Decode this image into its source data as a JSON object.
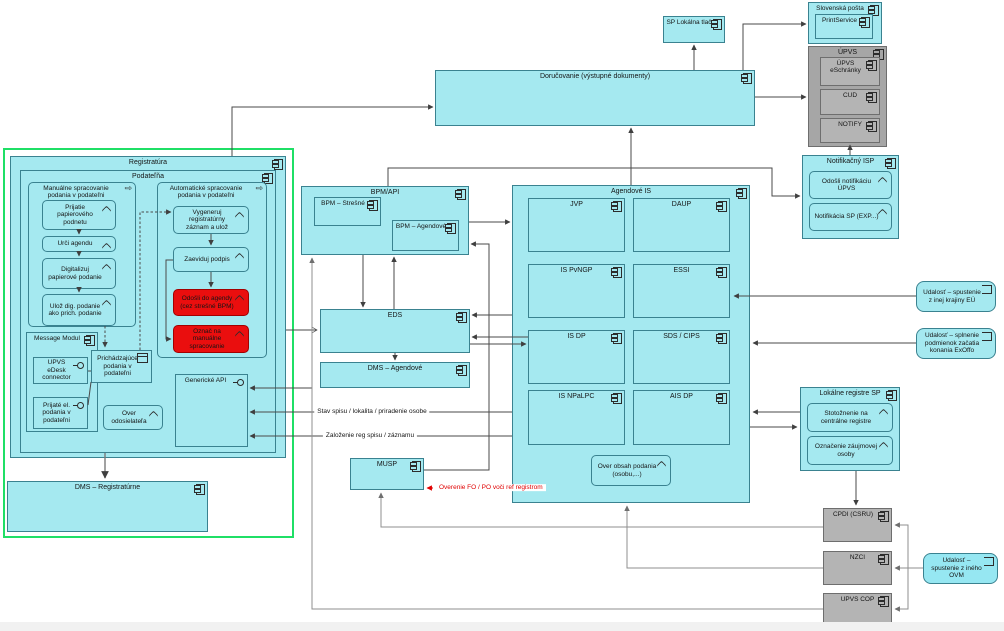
{
  "colors": {
    "node_fill": "#a5e9f0",
    "gray_fill": "#b4b4b4",
    "alert_fill": "#ea0e0e",
    "highlight_frame": "#1fdf66",
    "annotation_red": "#e00000"
  },
  "registratura": {
    "title": "Registratúra"
  },
  "podatelna": {
    "title": "Podateľňa"
  },
  "manualne": {
    "title": "Manuálne spracovanie podania v podateľni",
    "steps": [
      "Prijatie papierového podnetu",
      "Urči agendu",
      "Digitalizuj papierové podanie",
      "Ulož dig. podanie ako prich. podanie"
    ]
  },
  "automaticke": {
    "title": "Automatické spracovanie podania v podateľni",
    "steps": [
      "Vygeneruj registratúrny záznam a ulož",
      "Zaeviduj podpis"
    ],
    "alerts": [
      "Odošli do agendy (cez strešné BPM)",
      "Označ na manuálne spracovanie"
    ]
  },
  "message_modul": {
    "title": "Message Modul",
    "items": [
      "UPVS eDesk connector",
      "Prijaté el. podania v podateľni"
    ]
  },
  "podatelna_misc": {
    "prichadzajuce": "Prichádzajúce podania v podateľni",
    "over_odosielatela": "Over odosielateľa",
    "genericke_api": "Generické API"
  },
  "dms_registraturne": {
    "title": "DMS – Registratúrne"
  },
  "bpm": {
    "title": "BPM/API",
    "stresne": "BPM – Strešné",
    "agendove": "BPM – Agendové"
  },
  "eds": {
    "title": "EDS"
  },
  "dms_agendove": {
    "title": "DMS – Agendové"
  },
  "musp": {
    "title": "MUSP"
  },
  "agendove_is": {
    "title": "Agendové IS",
    "modules": [
      "JVP",
      "DAUP",
      "IS PvNGP",
      "ESSI",
      "IS DP",
      "SDS / CIPS",
      "IS NPaLPC",
      "AIS DP"
    ],
    "over_obsah": "Over obsah podania (osobu,...)"
  },
  "dorucovanie": {
    "title": "Doručovanie (výstupné dokumenty)"
  },
  "sp_lokalna_tlac": {
    "title": "SP Lokálna tlač"
  },
  "slovenska_posta": {
    "title": "Slovenská pošta",
    "printservice": "PrintService"
  },
  "upvs": {
    "title": "ÚPVS",
    "eschranky": "ÚPVS eSchránky",
    "cud": "CUD",
    "notify": "NOTIFY"
  },
  "notifikacny_isp": {
    "title": "Notifikačný ISP",
    "odosli": "Odošli notifikáciu ÚPVS",
    "notifikacia": "Notifikácia SP (EXP...)"
  },
  "events": {
    "eu": "Udalosť – spustenie z inej krajiny EÚ",
    "exoffo": "Udalosť – splnenie podmienok začatia konania ExOffo",
    "ovm": "Udalosť – spustenie z iného OVM"
  },
  "lokalne_registre": {
    "title": "Lokálne registre SP",
    "stotoznenie": "Stotožnenie na centrálne registre",
    "oznacenie": "Označenie záujmovej osoby"
  },
  "externe": {
    "cpdi": "CPDI (CSRU)",
    "nzci": "NZCI",
    "upvs_cop": "UPVS COP"
  },
  "edge_labels": {
    "stav_spisu": "Stav spisu / lokalita / priradenie osobe",
    "zalozenie": "Založenie reg spisu / záznamu",
    "overenie": "Overenie FO / PO voči ref registrom"
  }
}
